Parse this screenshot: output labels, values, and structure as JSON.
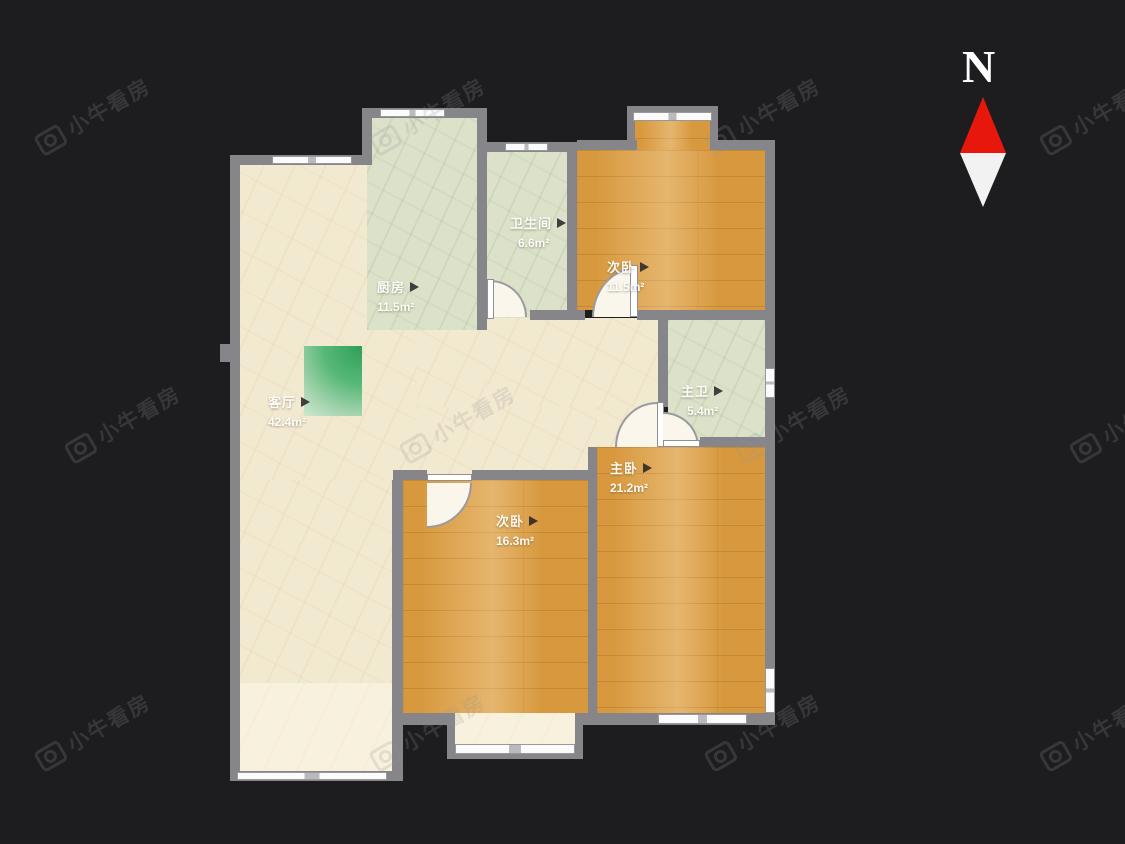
{
  "watermark": {
    "text": "小牛看房",
    "icon": "camera-icon"
  },
  "compass": {
    "north_label": "N"
  },
  "floorplan": {
    "rooms": [
      {
        "id": "living-room",
        "name": "客厅",
        "area": "42.4m²"
      },
      {
        "id": "kitchen",
        "name": "厨房",
        "area": "11.5m²"
      },
      {
        "id": "bathroom",
        "name": "卫生间",
        "area": "6.6m²"
      },
      {
        "id": "bedroom-north",
        "name": "次卧",
        "area": "11.5m²"
      },
      {
        "id": "master-bath",
        "name": "主卫",
        "area": "5.4m²"
      },
      {
        "id": "master-bedroom",
        "name": "主卧",
        "area": "21.2m²"
      },
      {
        "id": "bedroom-south",
        "name": "次卧",
        "area": "16.3m²"
      }
    ]
  }
}
